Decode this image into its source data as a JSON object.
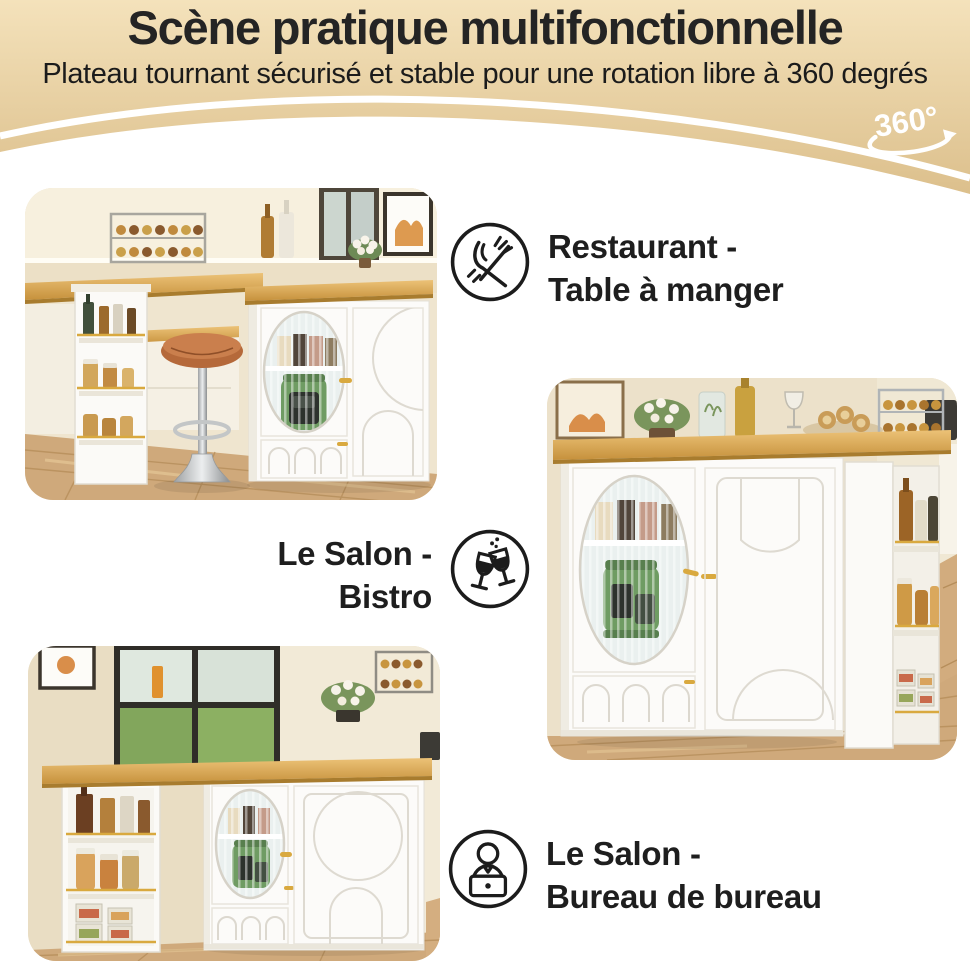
{
  "header": {
    "title": "Scène pratique multifonctionnelle",
    "subtitle": "Plateau tournant sécurisé et stable pour une rotation libre à 360 degrés",
    "rotation_badge": "360°"
  },
  "captions": {
    "dining": {
      "line1": "Restaurant -",
      "line2": "Table à manger",
      "icon": "fork-knife"
    },
    "bistro": {
      "line1": "Le Salon -",
      "line2": "Bistro",
      "icon": "wine-glasses"
    },
    "office": {
      "line1": "Le Salon -",
      "line2": "Bureau de bureau",
      "icon": "person-laptop"
    }
  },
  "photos": {
    "dining_alt": "Îlot de cuisine blanc avec tabouret de bar en cuir et vitrine cannelée",
    "bistro_alt": "Îlot blanc vu de face avec étagères latérales garnies de bouteilles et bocaux",
    "office_alt": "Îlot blanc près d'une fenêtre avec étagère à bouteilles et bocaux"
  },
  "colors": {
    "header_top": "#f4e2bb",
    "header_bottom": "#d9bb86",
    "text_dark": "#1e1e1e",
    "badge_white": "#ffffff",
    "wood": "#d9a84e",
    "accent_gold": "#d9a93f",
    "appliance_green": "#6f9c63"
  }
}
